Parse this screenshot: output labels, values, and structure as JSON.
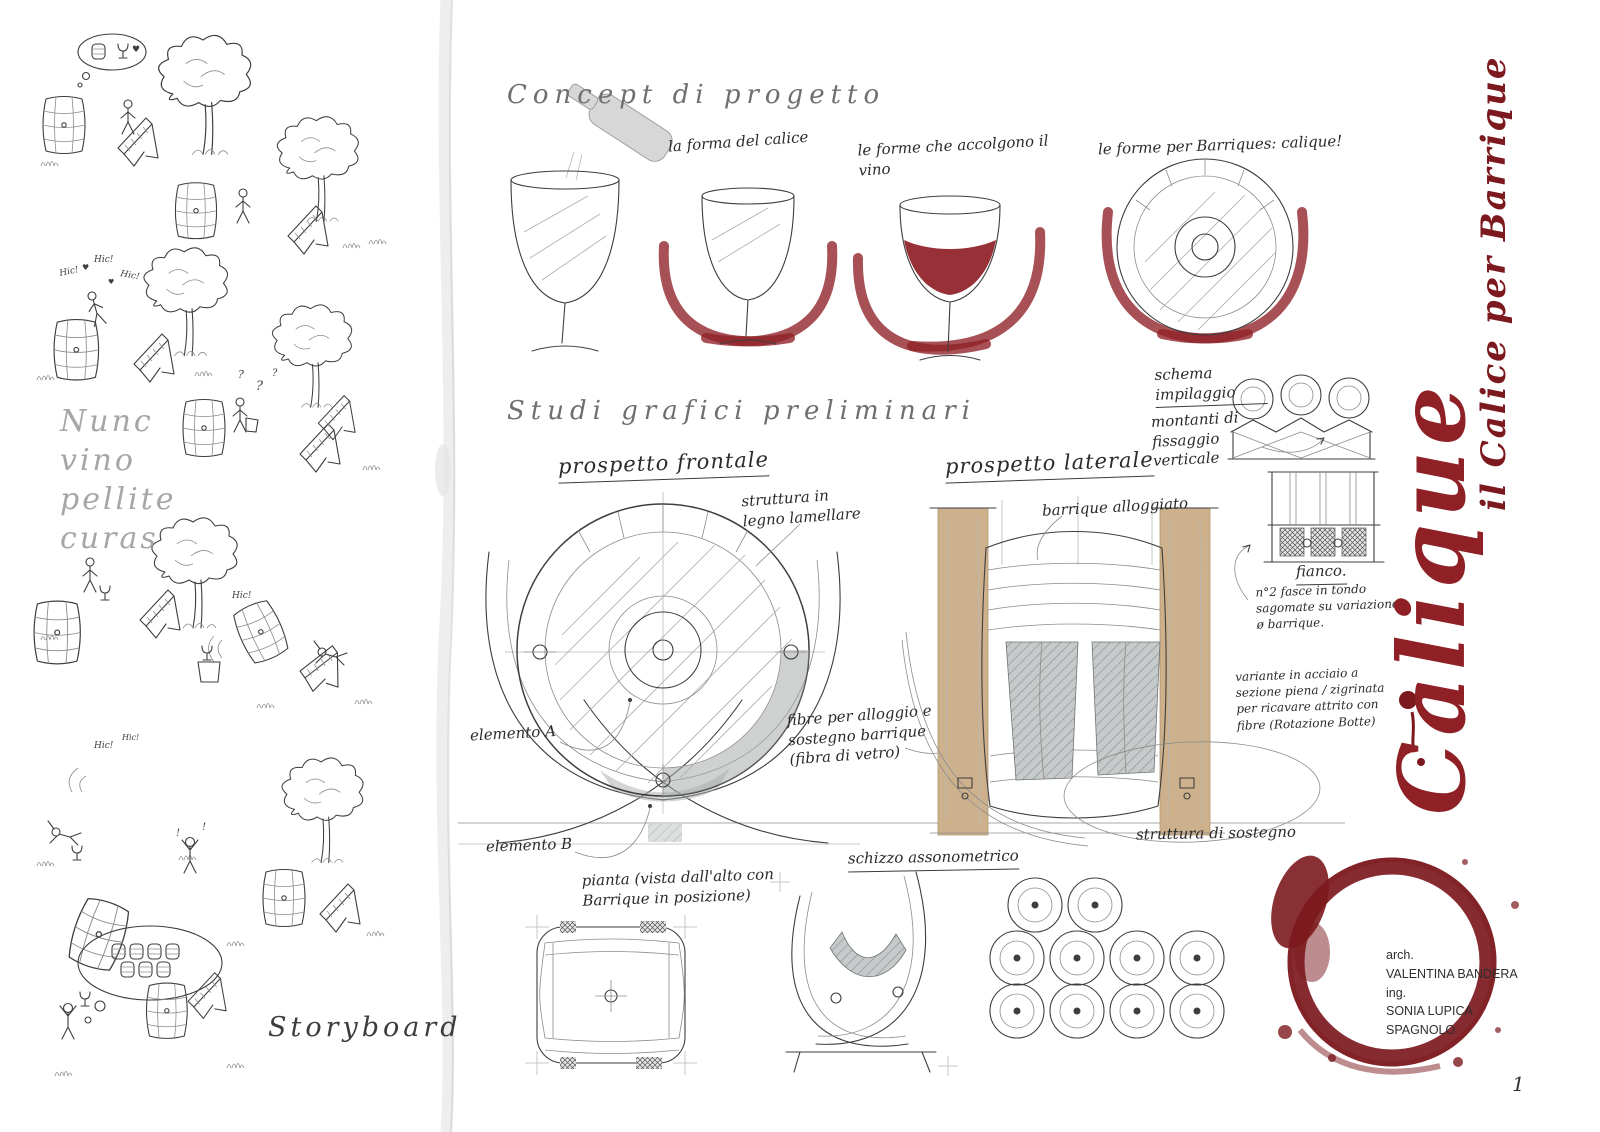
{
  "colors": {
    "wine_red": "#8e2026",
    "ring_red": "#7c191e",
    "wood_tan": "#cdb18c",
    "ink": "#3e3e3e",
    "paper": "#ffffff"
  },
  "left_panel": {
    "quote_lines": [
      "Nunc",
      "vino",
      "pellite",
      "curas"
    ],
    "storyboard_label": "Storyboard"
  },
  "storyboard": {
    "sounds": {
      "hic": "Hic!",
      "question": "?",
      "heart": "♥",
      "exclaim": "!"
    }
  },
  "concept": {
    "heading": "Concept di progetto",
    "captions": [
      {
        "text": "la forma del calice"
      },
      {
        "text": "le forme che accolgono il vino"
      },
      {
        "text": "le forme per Barriques: calique!"
      }
    ]
  },
  "studies": {
    "heading": "Studi  grafici preliminari",
    "front_view_label": "prospetto frontale",
    "side_view_label": "prospetto laterale",
    "annotations": {
      "wood_structure": "struttura in legno lamellare",
      "barrique_housed": "barrique alloggiato",
      "element_a": "elemento A",
      "element_b": "elemento B",
      "fibers": "fibre per alloggio e sostegno barrique (fibra di vetro)",
      "plan": "pianta (vista dall'alto con Barrique in posizione)",
      "axon": "schizzo assonometrico",
      "stack_scheme": "schema impilaggio",
      "uprights": "montanti di fissaggio verticale",
      "side_label": "fianco.",
      "bands_note": "n°2 fasce in tondo sagomate su variazione ø barrique.",
      "steel_note": "variante in acciaio a sezione piena / zigrinata per ricavare attrito con fibre (Rotazione Botte)",
      "support": "struttura di sostegno"
    }
  },
  "title_block": {
    "brand": "Calique",
    "subtitle": "il Calice per Barrique"
  },
  "credits": {
    "arch_label": "arch.",
    "architect": "VALENTINA BANDERA",
    "ing_label": "ing.",
    "engineer": "SONIA LUPICA SPAGNOLO"
  },
  "page_number": "1"
}
